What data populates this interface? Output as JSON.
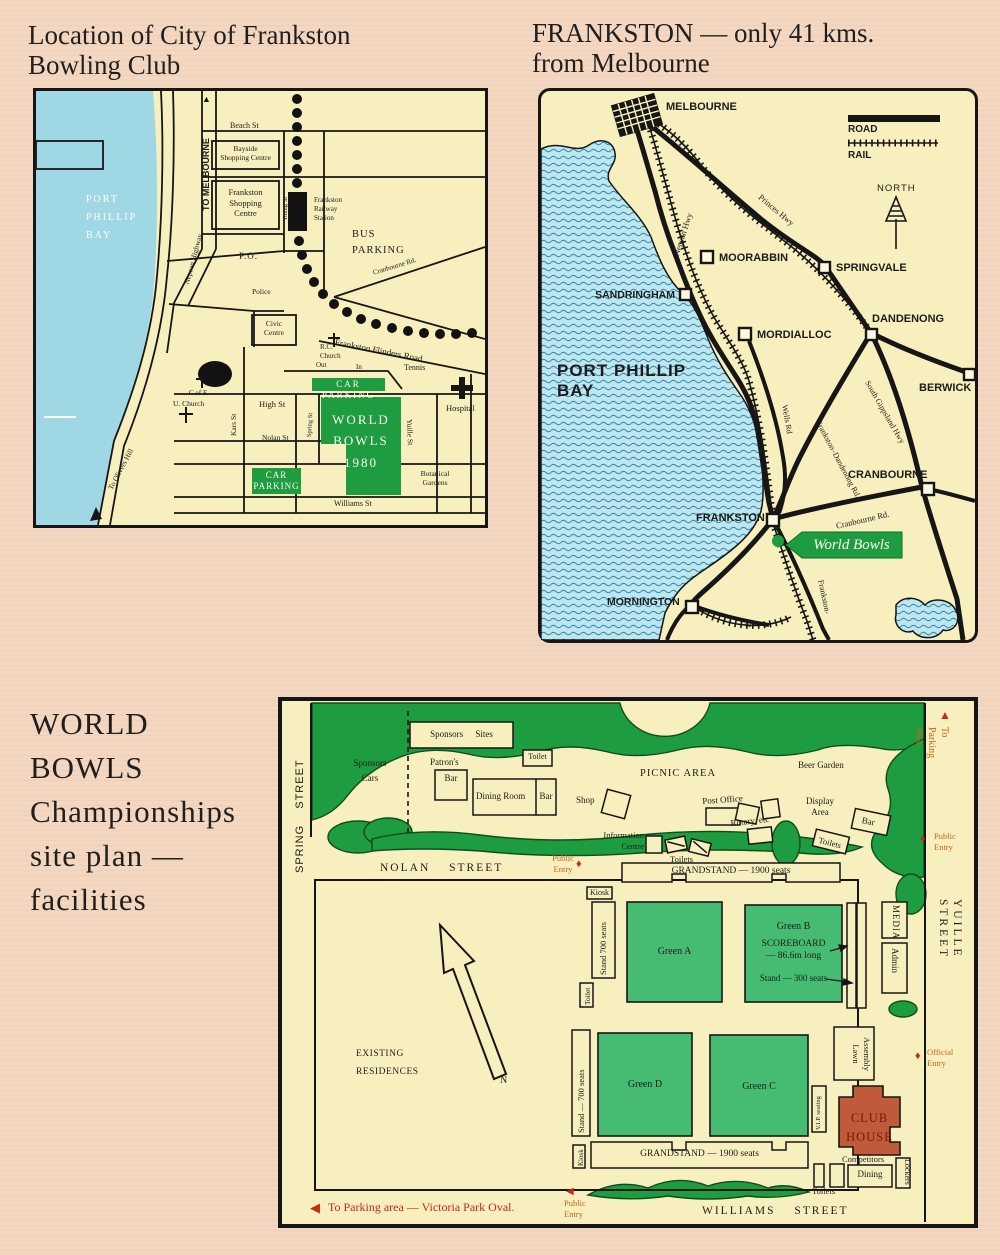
{
  "icons": {
    "up_arrow": "▲",
    "left_arrow": "◀",
    "down_arrow": "▼",
    "diamond": "♦"
  },
  "colors": {
    "page_bg": "#f3d7c1",
    "map_bg": "#f8efbe",
    "water": "#9fd8e4",
    "green_dark": "#1d9c40",
    "green_light": "#45bc72",
    "clubhouse": "#bf5b3b",
    "red": "#c62a12",
    "orange": "#c8661c"
  },
  "map1": {
    "title_line1": "Location of City of Frankston",
    "title_line2": "Bowling Club",
    "labels": {
      "bay": "PORT\nPHILLIP\nBAY",
      "to_melbourne": "TO MELBOURNE",
      "beach_st": "Beach St",
      "bayside": "Bayside\nShopping Centre",
      "frankston_shopping": "Frankston\nShopping\nCentre",
      "young_st": "Young St",
      "railway_station": "Frankston\nRailway\nStation",
      "bus_parking": "BUS\nPARKING",
      "nepean_hwy": "Nepean Highway",
      "po": "P.O.",
      "police": "Police",
      "cranbourne_rd": "Cranbourne Rd.",
      "civic_centre": "Civic\nCentre",
      "flinders_rd": "Frankston Flinders Road",
      "rc_church": "R.C.\nChurch",
      "out": "Out",
      "in": "In",
      "car_parking_top": "CAR PARKING",
      "tennis": "Tennis",
      "hospital": "Hospital",
      "c_of_e": "C of E",
      "u_church": "U. Church",
      "kars_st": "Kars St",
      "high_st": "High St",
      "nolan_st": "Nolan St",
      "spring_st": "Spring St",
      "world_bowls": "WORLD\nBOWLS\n1980",
      "yuille_st": "Yuille St",
      "car_parking_lower": "CAR\nPARKING",
      "botanical": "Botanical\nGardens",
      "williams_st": "Williams St",
      "olivers_hill": "To Olivers Hill"
    }
  },
  "map2": {
    "title_line1": "FRANKSTON — only 41 kms.",
    "title_line2": "from Melbourne",
    "labels": {
      "melbourne": "MELBOURNE",
      "moorabbin": "MOORABBIN",
      "springvale": "SPRINGVALE",
      "sandringham": "SANDRINGHAM",
      "mordialloc": "MORDIALLOC",
      "dandenong": "DANDENONG",
      "berwick": "BERWICK",
      "cranbourne": "CRANBOURNE",
      "frankston": "FRANKSTON",
      "mornington": "MORNINGTON",
      "legend_road": "ROAD",
      "legend_rail": "RAIL",
      "north": "NORTH",
      "nepean_hwy": "Nepean Hwy",
      "princes_hwy": "Princes Hwy",
      "wells_rd": "Wells Rd",
      "frankston_dandenong_rd": "Frankston–Dandenong Rd.",
      "south_gippsland_hwy": "South Gippsland Hwy",
      "cranbourne_rd": "Cranbourne Rd.",
      "frankston_rail": "Frankston-",
      "rd": "Rd.",
      "bay": "PORT PHILLIP\nBAY",
      "world_bowls": "World Bowls"
    }
  },
  "siteplan": {
    "title": "WORLD\nBOWLS\nChampionships\nsite plan —\nfacilities",
    "labels": {
      "spring_street": "SPRING STREET",
      "nolan_street": "NOLAN STREET",
      "yuille_street": "YUILLE STREET",
      "williams_street": "WILLIAMS STREET",
      "sponsors_cars": "Sponsors\nCars",
      "sponsors_sites": "Sponsors Sites",
      "toilet_north": "Toilet",
      "patrons": "Patron's",
      "patrons_bar": "Bar",
      "dining_room": "Dining Room",
      "dining_bar": "Bar",
      "shop": "Shop",
      "picnic_area": "PICNIC AREA",
      "beer_garden": "Beer Garden",
      "post_office": "Post Office",
      "rotary": "Rotary, etc",
      "display_area": "Display\nArea",
      "bar_east": "Bar",
      "toilets_east": "Toilets",
      "info_centre": "Information\nCentre",
      "toilets_mid": "Toilets",
      "grandstand_north": "GRANDSTAND — 1900 seats",
      "kiosk_north": "Kiosk",
      "stand_700_north": "Stand 700 seats",
      "toilet_west": "Toilet",
      "green_a": "Green A",
      "green_b": "Green B",
      "scoreboard": "SCOREBOARD\n— 86.6m long",
      "stand_300": "Stand — 300 seats",
      "media": "MEDIA",
      "admin": "Admin",
      "assembly_lawn": "Assembly\nLawn",
      "green_d": "Green D",
      "green_c": "Green C",
      "stand_700_south": "Stand — 700 seats",
      "vip": "V.I.P. seating",
      "club_house": "CLUB\nHOUSE",
      "kiosk_south": "Kiosk",
      "grandstand_south": "GRANDSTAND — 1900 seats",
      "competitors": "Competitors",
      "dining": "Dining",
      "lockers": "Lockers",
      "toilets_south": "Toilets",
      "existing_residences": "EXISTING\nRESIDENCES",
      "north_n": "N",
      "public_entry": "Public\nEntry",
      "official_entry": "Official\nEntry",
      "to_parking_right": "To Parking area",
      "to_parking_bottom": "To Parking area — Victoria Park Oval."
    }
  }
}
